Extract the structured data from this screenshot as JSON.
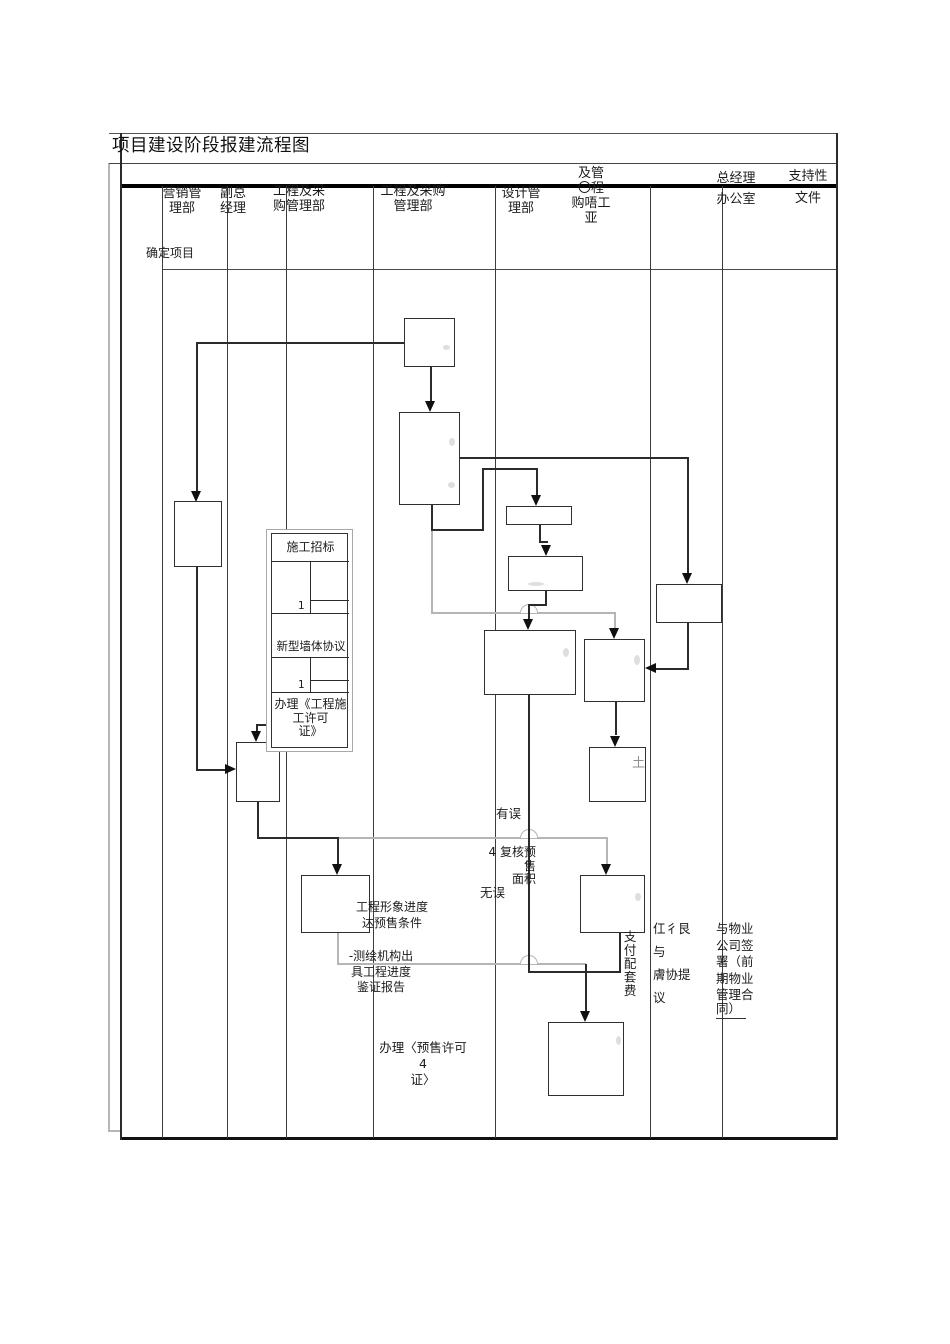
{
  "title": "项目建设阶段报建流程图",
  "header": {
    "lanes": [
      {
        "label": "营销管\n理部"
      },
      {
        "label": "副总\n经理"
      },
      {
        "label": "工程及采\n购管理部"
      },
      {
        "label": "工程及采购\n管理部"
      },
      {
        "label": "设计管\n理部"
      },
      {
        "label": "及管\n〇程\n购唔工\n亚"
      },
      {
        "label": "总经理\n办公室"
      },
      {
        "label": "支持性\n文件"
      }
    ]
  },
  "row_label": "确定项目",
  "group_box": {
    "section1": "施工招标",
    "marker1": "1",
    "section2": "新型墙体协议",
    "marker2": "1",
    "section3": "办理《工程施\n工许可\n证》"
  },
  "labels": {
    "progress_condition": "工程形象进度\n达预售条件",
    "survey_report": "-测绘机构出\n具工程进度\n鉴证报告",
    "presale_permit": "办理〈预售许可 4\n证〉",
    "error": "有误",
    "recheck_area": "4 复核预售\n面积",
    "no_error": "无误",
    "pay_fee": "支付配套费",
    "garbled_note": "仜彳艮\n与\n膚协提\n议",
    "property_sign_main": "与物业\n公司签\n署（前\n期物业\n管理合",
    "property_sign_tail": "同）",
    "soil_mark": "土"
  },
  "colors": {
    "line": "#2b2b2b",
    "loop_line": "#b5b5b5",
    "header_rule": "#000000"
  }
}
